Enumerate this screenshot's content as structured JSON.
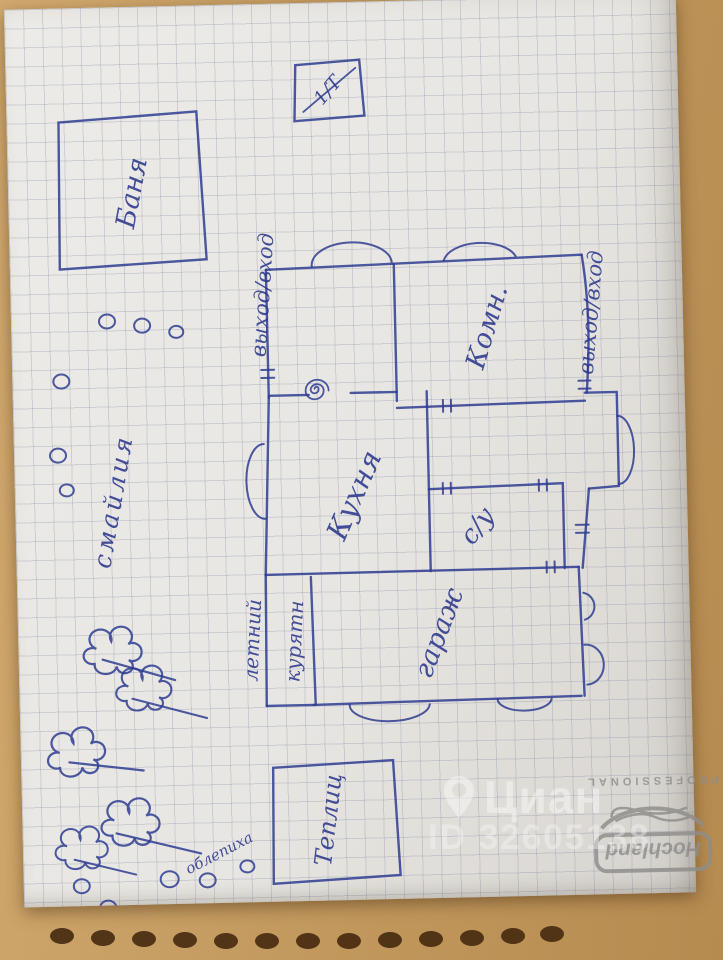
{
  "floor_plan": {
    "bathhouse_label": "Баня",
    "utility_box_label": "1/Т",
    "exit_left_label": "выход/вход",
    "exit_right_label": "выход/вход",
    "room_label": "Комн.",
    "kitchen_label": "Кухня",
    "wc_label": "с/у",
    "garage_label": "гараж",
    "coop_label_line1": "летний",
    "coop_label_line2": "курятн",
    "greenhouse_label": "Теплиц",
    "garden_word_vertical": "смайлия",
    "garden_word_diagonal": "облепиха"
  },
  "watermark": {
    "brand": "Циан",
    "listing_id": "ID 32605138",
    "color": "#ffffff"
  },
  "notepad": {
    "brand": "Hochland",
    "brand_subtitle": "PROFESSIONAL",
    "print_color": "#8f8d8a"
  },
  "pen_color": "#2b378c",
  "paper_color": "#e8e6e2",
  "wood_color": "#c49b60"
}
